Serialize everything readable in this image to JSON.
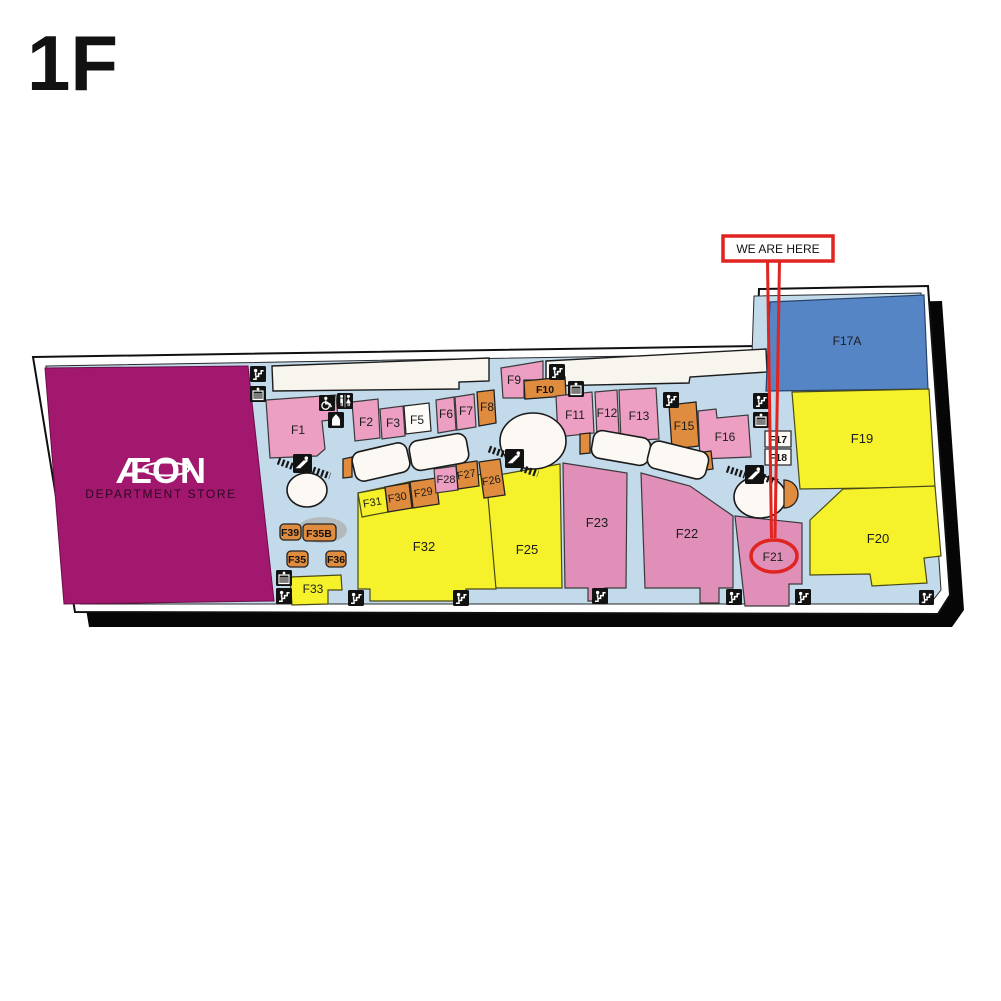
{
  "floor": {
    "title": "1F"
  },
  "marker": {
    "label": "WE ARE HERE",
    "circled_unit": "F21"
  },
  "anchor": {
    "name": "ÆON",
    "subtitle": "DEPARTMENT STORE"
  },
  "palette": {
    "magenta": "#A1186E",
    "pink": "#EC9FC2",
    "pink_dark": "#E08FB8",
    "yellow": "#F5F22B",
    "orange": "#E08C3E",
    "blue": "#5585C5",
    "floor_blue": "#C2DAEA",
    "walkway_cream": "#F8F4EE",
    "highlight_red": "#E02420",
    "shadow_black": "#060606"
  },
  "icons": {
    "stairs": "black square, white staircase with figure",
    "escalator": "black square, white escalator box",
    "escalator_diagonal": "black square, figure on diagonal escalator with hatch marks",
    "accessible_toilet": "wheelchair symbol",
    "toilet": "male and female figures",
    "prayer_room": "white dome symbol"
  },
  "units": [
    {
      "id": "F1",
      "label": "F1",
      "category": "pink"
    },
    {
      "id": "F2",
      "label": "F2",
      "category": "pink"
    },
    {
      "id": "F3",
      "label": "F3",
      "category": "pink"
    },
    {
      "id": "F5",
      "label": "F5",
      "category": "white"
    },
    {
      "id": "F6",
      "label": "F6",
      "category": "pink"
    },
    {
      "id": "F7",
      "label": "F7",
      "category": "pink"
    },
    {
      "id": "F8",
      "label": "F8",
      "category": "orange"
    },
    {
      "id": "F9",
      "label": "F9",
      "category": "pink"
    },
    {
      "id": "F10",
      "label": "F10",
      "category": "orange"
    },
    {
      "id": "F11",
      "label": "F11",
      "category": "pink"
    },
    {
      "id": "F12",
      "label": "F12",
      "category": "pink"
    },
    {
      "id": "F13",
      "label": "F13",
      "category": "pink"
    },
    {
      "id": "F15",
      "label": "F15",
      "category": "orange"
    },
    {
      "id": "F16",
      "label": "F16",
      "category": "pink"
    },
    {
      "id": "F17A",
      "label": "F17A",
      "category": "blue"
    },
    {
      "id": "F17",
      "label": "F17",
      "category": "white"
    },
    {
      "id": "F18",
      "label": "F18",
      "category": "white"
    },
    {
      "id": "F19",
      "label": "F19",
      "category": "yellow"
    },
    {
      "id": "F20",
      "label": "F20",
      "category": "yellow"
    },
    {
      "id": "F21",
      "label": "F21",
      "category": "pink_dark"
    },
    {
      "id": "F22",
      "label": "F22",
      "category": "pink_dark"
    },
    {
      "id": "F23",
      "label": "F23",
      "category": "pink_dark"
    },
    {
      "id": "F25",
      "label": "F25",
      "category": "yellow"
    },
    {
      "id": "F26",
      "label": "F26",
      "category": "orange"
    },
    {
      "id": "F27",
      "label": "F27",
      "category": "orange"
    },
    {
      "id": "F28",
      "label": "F28",
      "category": "pink"
    },
    {
      "id": "F29",
      "label": "F29",
      "category": "orange"
    },
    {
      "id": "F30",
      "label": "F30",
      "category": "orange"
    },
    {
      "id": "F31",
      "label": "F31",
      "category": "yellow"
    },
    {
      "id": "F32",
      "label": "F32",
      "category": "yellow"
    },
    {
      "id": "F33",
      "label": "F33",
      "category": "yellow"
    },
    {
      "id": "F35",
      "label": "F35",
      "category": "orange"
    },
    {
      "id": "F35B",
      "label": "F35B",
      "category": "orange"
    },
    {
      "id": "F36",
      "label": "F36",
      "category": "orange"
    },
    {
      "id": "F39",
      "label": "F39",
      "category": "orange"
    }
  ]
}
